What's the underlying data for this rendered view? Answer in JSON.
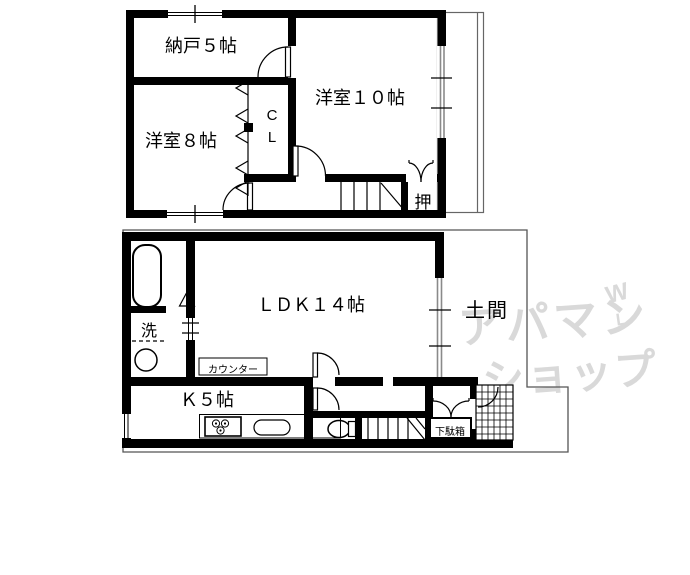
{
  "plan": {
    "upper_floor": {
      "storage_room": "納戸５帖",
      "western_room_10": "洋室１０帖",
      "western_room_8": "洋室８帖",
      "closet_c": "C",
      "closet_l": "L",
      "oshiire": "押"
    },
    "lower_floor": {
      "ldk": "ＬＤＫ１４帖",
      "doma": "土間",
      "laundry": "洗",
      "counter": "カウンター",
      "kitchen": "Ｋ５帖",
      "shoe_cabinet": "下駄箱"
    },
    "watermark": {
      "line1": "アパマン",
      "line2": "ショップ",
      "mark_w": "W",
      "mark_l": "L",
      "color": "#d9d9d9"
    },
    "colors": {
      "wall": "#000000",
      "thin_outline": "#555555",
      "window_gray": "#8a8a8a",
      "background": "#ffffff"
    }
  }
}
